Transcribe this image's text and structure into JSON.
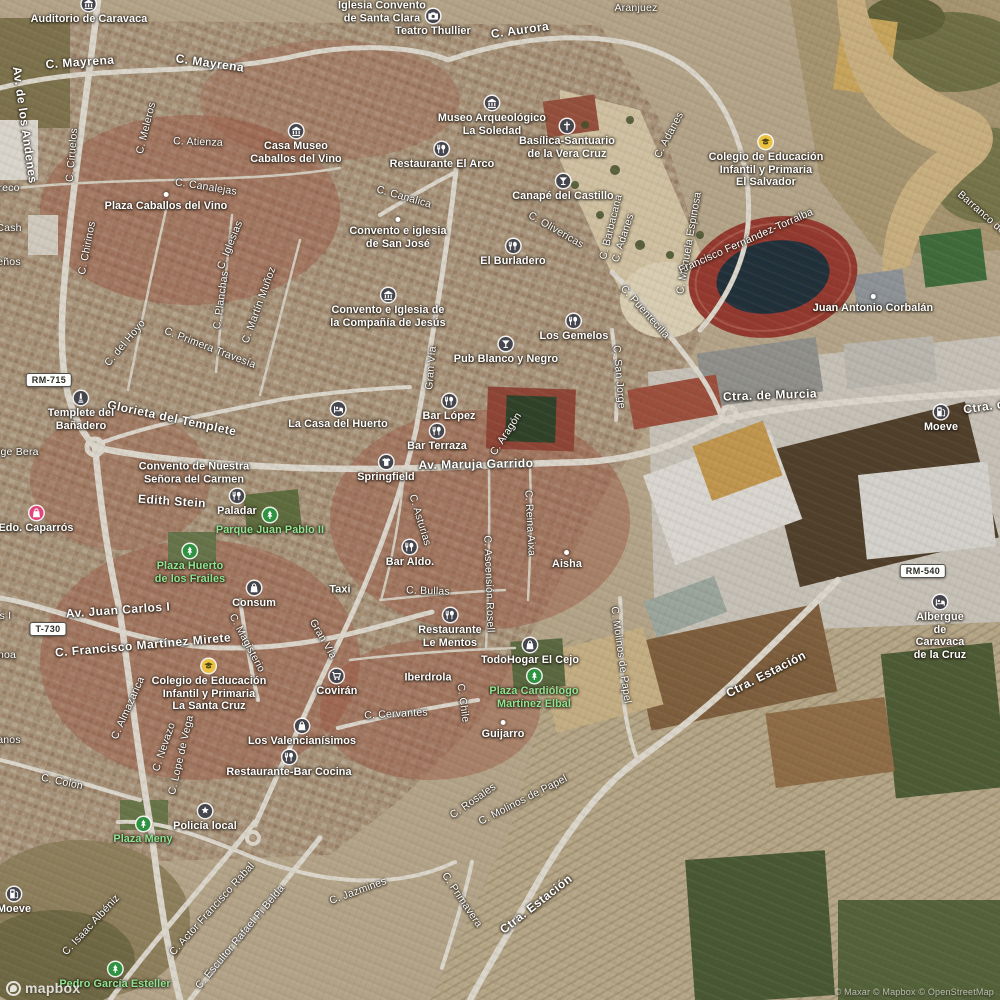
{
  "map": {
    "brand": "mapbox",
    "attribution": "© Maxar © Mapbox © OpenStreetMap",
    "colors": {
      "street_text": "#ffffff",
      "green_label_text": "#8fe68f",
      "poi_icon_bg": "#45454d",
      "park_icon_bg": "#2f9240",
      "school_icon_bg": "#eac23f",
      "shop_pink_icon_bg": "#e0447a",
      "shield_bg": "#fdfdfb",
      "shield_text": "#2b2b28",
      "stadium_track": "#93392f"
    },
    "shields": [
      {
        "text": "RM-715",
        "x": 49,
        "y": 380
      },
      {
        "text": "T-730",
        "x": 48,
        "y": 629
      },
      {
        "text": "RM-540",
        "x": 923,
        "y": 571
      }
    ],
    "streets": [
      {
        "text": "C. Mayrena",
        "x": 80,
        "y": 62,
        "rot": -4,
        "cls": "major"
      },
      {
        "text": "C. Mayrena",
        "x": 210,
        "y": 63,
        "rot": 8,
        "cls": "major"
      },
      {
        "text": "Av. de los Andenes",
        "x": 25,
        "y": 125,
        "rot": 82,
        "cls": "major"
      },
      {
        "text": "C. Ciruelos",
        "x": 72,
        "y": 155,
        "rot": -85
      },
      {
        "text": "C. Meleros",
        "x": 146,
        "y": 128,
        "rot": -76
      },
      {
        "text": "C. Atienza",
        "x": 198,
        "y": 142,
        "rot": 2
      },
      {
        "text": "C. Chirinos",
        "x": 87,
        "y": 248,
        "rot": -79
      },
      {
        "text": "C. Canalejas",
        "x": 206,
        "y": 187,
        "rot": 9
      },
      {
        "text": "C. Iglesias",
        "x": 230,
        "y": 245,
        "rot": -68
      },
      {
        "text": "C. Planchas",
        "x": 221,
        "y": 300,
        "rot": -82
      },
      {
        "text": "C. Martín Muñoz",
        "x": 259,
        "y": 305,
        "rot": -70
      },
      {
        "text": "C. Primera Travesía",
        "x": 210,
        "y": 348,
        "rot": 21
      },
      {
        "text": "C. del Hoyo",
        "x": 125,
        "y": 343,
        "rot": -50
      },
      {
        "text": "areco",
        "x": 6,
        "y": 188,
        "rot": 0
      },
      {
        "text": "Cash",
        "x": 9,
        "y": 228,
        "rot": 0
      },
      {
        "text": "eños",
        "x": 9,
        "y": 262,
        "rot": 0
      },
      {
        "text": "C. Canalica",
        "x": 404,
        "y": 197,
        "rot": 16
      },
      {
        "text": "C. Olivericas",
        "x": 556,
        "y": 230,
        "rot": 30
      },
      {
        "text": "C. Barbacana",
        "x": 611,
        "y": 227,
        "rot": -76
      },
      {
        "text": "C. Adanes",
        "x": 623,
        "y": 238,
        "rot": -72
      },
      {
        "text": "C. Adanes",
        "x": 669,
        "y": 135,
        "rot": -62
      },
      {
        "text": "C. Manuela Espinosa",
        "x": 689,
        "y": 243,
        "rot": -80
      },
      {
        "text": "C. Puentecilla",
        "x": 645,
        "y": 312,
        "rot": 48
      },
      {
        "text": "C. San Jorge",
        "x": 619,
        "y": 377,
        "rot": 85
      },
      {
        "text": "Gran Vía",
        "x": 431,
        "y": 368,
        "rot": -85
      },
      {
        "text": "Gran Vía",
        "x": 323,
        "y": 639,
        "rot": 60
      },
      {
        "text": "C. Aurora",
        "x": 520,
        "y": 30,
        "rot": -8,
        "cls": "major"
      },
      {
        "text": "Aranjuez",
        "x": 636,
        "y": 8,
        "rot": 0
      },
      {
        "text": "C. Aragón",
        "x": 506,
        "y": 434,
        "rot": -57
      },
      {
        "text": "Av. Maruja Garrido",
        "x": 476,
        "y": 464,
        "rot": -1,
        "cls": "major"
      },
      {
        "text": "C. Asturias",
        "x": 420,
        "y": 520,
        "rot": 73
      },
      {
        "text": "C. Reina Aixa",
        "x": 530,
        "y": 523,
        "rot": 87
      },
      {
        "text": "C. Ascensión Rosell",
        "x": 489,
        "y": 584,
        "rot": 88
      },
      {
        "text": "C. Bullas",
        "x": 428,
        "y": 591,
        "rot": 2
      },
      {
        "text": "Edith Stein",
        "x": 172,
        "y": 501,
        "rot": 4,
        "cls": "major"
      },
      {
        "text": "Glorieta del Templete",
        "x": 172,
        "y": 418,
        "rot": 12,
        "cls": "major"
      },
      {
        "text": "Jorge Bera",
        "x": 12,
        "y": 452,
        "rot": 0
      },
      {
        "text": "Av. Juan Carlos I",
        "x": 118,
        "y": 610,
        "rot": -4,
        "cls": "major"
      },
      {
        "text": "Av. Juan Carlos I",
        "x": -30,
        "y": 616,
        "rot": 0
      },
      {
        "text": "C. Francisco Martínez Mirete",
        "x": 143,
        "y": 645,
        "rot": -5,
        "cls": "major"
      },
      {
        "text": "C. Magisterio",
        "x": 247,
        "y": 643,
        "rot": 62
      },
      {
        "text": "C. Almazarica",
        "x": 128,
        "y": 708,
        "rot": -66
      },
      {
        "text": "C. Nevazo",
        "x": 164,
        "y": 747,
        "rot": -71
      },
      {
        "text": "C. Lope de Vega",
        "x": 181,
        "y": 755,
        "rot": -77
      },
      {
        "text": "C. Colón",
        "x": 62,
        "y": 782,
        "rot": 12
      },
      {
        "text": "noa",
        "x": 7,
        "y": 655,
        "rot": 0
      },
      {
        "text": "anos",
        "x": 9,
        "y": 740,
        "rot": 0
      },
      {
        "text": "C. Cervantes",
        "x": 396,
        "y": 714,
        "rot": -3
      },
      {
        "text": "C. Chile",
        "x": 463,
        "y": 703,
        "rot": 82
      },
      {
        "text": "C. Molinos de Papel",
        "x": 621,
        "y": 655,
        "rot": 82
      },
      {
        "text": "Ctra. Estación",
        "x": 766,
        "y": 674,
        "rot": -27,
        "cls": "major"
      },
      {
        "text": "Ctra. de Murcia",
        "x": 770,
        "y": 395,
        "rot": -2,
        "cls": "major"
      },
      {
        "text": "Ctra. de Murcia",
        "x": 1010,
        "y": 403,
        "rot": -8,
        "cls": "major"
      },
      {
        "text": "C. Rosales",
        "x": 473,
        "y": 801,
        "rot": -35
      },
      {
        "text": "C. Molinos de Papel",
        "x": 523,
        "y": 800,
        "rot": -27
      },
      {
        "text": "Ctra. Estación",
        "x": 536,
        "y": 904,
        "rot": -38,
        "cls": "major"
      },
      {
        "text": "C. Jazmines",
        "x": 358,
        "y": 891,
        "rot": -20
      },
      {
        "text": "C. Primavera",
        "x": 462,
        "y": 900,
        "rot": 56
      },
      {
        "text": "C. Isaac Albéniz",
        "x": 91,
        "y": 925,
        "rot": -47
      },
      {
        "text": "C. Actor Francisco Rabal",
        "x": 212,
        "y": 909,
        "rot": -48
      },
      {
        "text": "C. Escultor Rafael Pi Belda",
        "x": 240,
        "y": 937,
        "rot": -50
      },
      {
        "text": "Barranco de San",
        "x": 990,
        "y": 220,
        "rot": 41
      },
      {
        "text": "Francisco Fernández-Torralba",
        "x": 746,
        "y": 241,
        "rot": -24
      }
    ],
    "pois": [
      {
        "text": "Auditorio de Caravaca",
        "x": 89,
        "y": 5,
        "icon": "museum-icon"
      },
      {
        "text": "Iglesia Convento\nde Santa Clara",
        "x": 382,
        "y": 11,
        "icon": "none"
      },
      {
        "text": "Teatro Thullier",
        "x": 433,
        "y": 17,
        "icon": "attraction-icon"
      },
      {
        "text": "Museo Arqueológico\nLa Soledad",
        "x": 492,
        "y": 104,
        "icon": "museum-icon"
      },
      {
        "text": "Basílica-Santuario\nde la Vera Cruz",
        "x": 567,
        "y": 127,
        "icon": "religious-icon"
      },
      {
        "text": "Canapé del Castillo",
        "x": 563,
        "y": 182,
        "icon": "bar-icon"
      },
      {
        "text": "Casa Museo\nCaballos del Vino",
        "x": 296,
        "y": 132,
        "icon": "museum-icon"
      },
      {
        "text": "Restaurante El Arco",
        "x": 442,
        "y": 150,
        "icon": "restaurant-icon"
      },
      {
        "text": "Plaza Caballos del Vino",
        "x": 166,
        "y": 200,
        "icon": "dot-icon"
      },
      {
        "text": "Convento e iglesia\nde San José",
        "x": 398,
        "y": 225,
        "icon": "dot-icon"
      },
      {
        "text": "El Burladero",
        "x": 513,
        "y": 247,
        "icon": "restaurant-icon"
      },
      {
        "text": "Convento e Iglesia de\nla Compañía de Jesús",
        "x": 388,
        "y": 296,
        "icon": "museum-icon"
      },
      {
        "text": "Los Gemelos",
        "x": 574,
        "y": 322,
        "icon": "restaurant-icon"
      },
      {
        "text": "Pub Blanco y Negro",
        "x": 506,
        "y": 345,
        "icon": "bar-icon"
      },
      {
        "text": "Bar López",
        "x": 449,
        "y": 402,
        "icon": "restaurant-icon"
      },
      {
        "text": "Bar Terraza",
        "x": 437,
        "y": 432,
        "icon": "restaurant-icon"
      },
      {
        "text": "La Casa del Huerto",
        "x": 338,
        "y": 410,
        "icon": "lodging-icon"
      },
      {
        "text": "Springfield",
        "x": 386,
        "y": 463,
        "icon": "clothing-icon"
      },
      {
        "text": "Templete del\nBañadero",
        "x": 81,
        "y": 399,
        "icon": "monument-icon"
      },
      {
        "text": "Convento de Nuestra\nSeñora del Carmen",
        "x": 194,
        "y": 472,
        "icon": "none"
      },
      {
        "text": "Paladar",
        "x": 237,
        "y": 497,
        "icon": "restaurant-icon"
      },
      {
        "text": "Parque Juan Pablo II",
        "x": 270,
        "y": 516,
        "icon": "park-icon",
        "green": true
      },
      {
        "text": "Edo. Caparrós",
        "x": 36,
        "y": 514,
        "icon": "shop-pink-icon"
      },
      {
        "text": "Plaza Huerto\nde los Frailes",
        "x": 190,
        "y": 552,
        "icon": "park-icon",
        "green": true
      },
      {
        "text": "Consum",
        "x": 254,
        "y": 589,
        "icon": "shopping-icon"
      },
      {
        "text": "Taxi",
        "x": 340,
        "y": 589,
        "icon": "none"
      },
      {
        "text": "Bar Aldo.",
        "x": 410,
        "y": 548,
        "icon": "restaurant-icon"
      },
      {
        "text": "Aisha",
        "x": 567,
        "y": 558,
        "icon": "dot-icon"
      },
      {
        "text": "Restaurante\nLe Mentos",
        "x": 450,
        "y": 616,
        "icon": "restaurant-icon"
      },
      {
        "text": "TodoHogar El Cejo",
        "x": 530,
        "y": 646,
        "icon": "shopping-icon"
      },
      {
        "text": "Plaza Cardiólogo\nMartínez Elbal",
        "x": 534,
        "y": 677,
        "icon": "park-icon",
        "green": true
      },
      {
        "text": "Covirán",
        "x": 337,
        "y": 677,
        "icon": "grocery-icon"
      },
      {
        "text": "Iberdrola",
        "x": 428,
        "y": 677,
        "icon": "none"
      },
      {
        "text": "Guijarro",
        "x": 503,
        "y": 728,
        "icon": "dot-icon"
      },
      {
        "text": "Los Valencianísimos",
        "x": 302,
        "y": 727,
        "icon": "shopping-icon"
      },
      {
        "text": "Restaurante-Bar Cocina",
        "x": 289,
        "y": 758,
        "icon": "restaurant-icon"
      },
      {
        "text": "Policía local",
        "x": 205,
        "y": 812,
        "icon": "police-icon"
      },
      {
        "text": "Plaza Meny",
        "x": 143,
        "y": 825,
        "icon": "park-icon",
        "green": true
      },
      {
        "text": "Pedro García Esteller",
        "x": 115,
        "y": 970,
        "icon": "park-icon",
        "green": true
      },
      {
        "text": "Moeve",
        "x": 14,
        "y": 895,
        "icon": "fuel-icon"
      },
      {
        "text": "Moeve",
        "x": 941,
        "y": 413,
        "icon": "fuel-icon"
      },
      {
        "text": "Colegio de Educación\nInfantil y Primaria\nLa Santa Cruz",
        "x": 209,
        "y": 667,
        "icon": "school-icon"
      },
      {
        "text": "Colegio de Educación\nInfantil y Primaria\nEl Salvador",
        "x": 766,
        "y": 143,
        "icon": "school-icon"
      },
      {
        "text": "Juan Antonio Corbalán",
        "x": 873,
        "y": 302,
        "icon": "dot-icon"
      },
      {
        "text": "Albergue de\nCaravaca de la Cruz",
        "x": 940,
        "y": 603,
        "icon": "lodging-icon"
      }
    ]
  }
}
